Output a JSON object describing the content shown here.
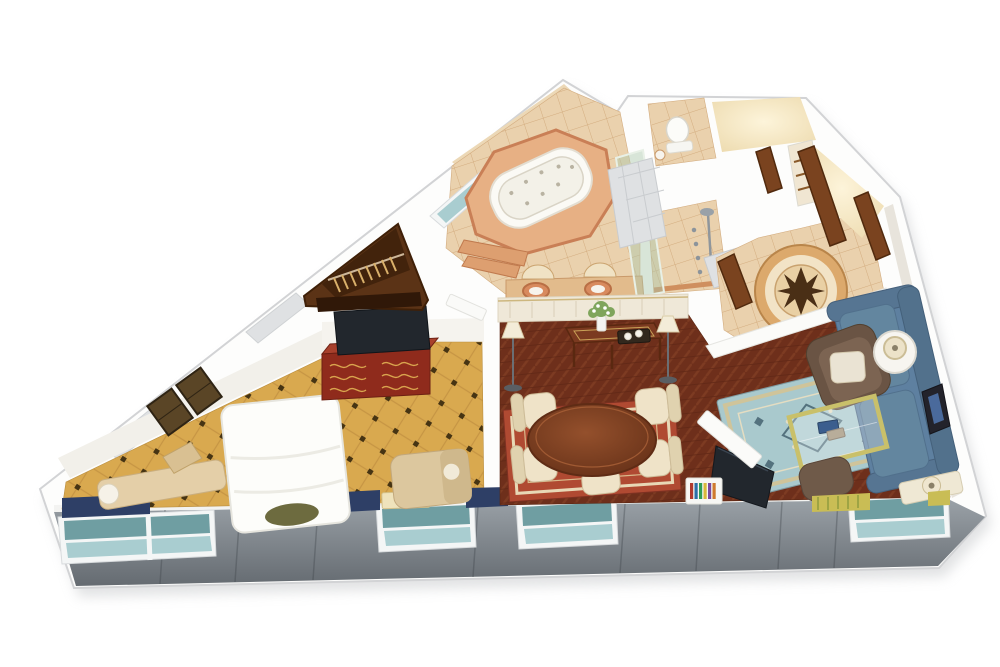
{
  "meta": {
    "subject": "isometric-3d-cutaway-floor-plan-of-hotel-suite",
    "background": "#ffffff",
    "width": 1000,
    "height": 667
  },
  "palette": {
    "wall_white": "#fdfdfc",
    "wall_shadow": "#c9cbcd",
    "wall_face": "#f2f0ea",
    "band_top": "#9aa1a7",
    "band_bottom": "#656b71",
    "window_frame": "#f4f6f6",
    "glass_dark": "#6f9ea2",
    "glass_light": "#a9cdd0",
    "carpet_gold": "#d9a94f",
    "carpet_line": "#c69544",
    "carpet_dot": "#463413",
    "wood_floor": "#6e2f1b",
    "wood_grain": "#7d3b22",
    "tile_tan": "#ead1ad",
    "tile_line": "#d3ac7f",
    "marble": "#dfe1e3",
    "closet_wood": "#5b3316",
    "closet_wood_dark": "#42230c",
    "hanger": "#d9b06a",
    "dresser_red": "#8f2b1c",
    "dresser_top": "#a8402c",
    "tv_dark": "#22272d",
    "bed_white": "#fdfdfa",
    "pillow_olive": "#6d6b3f",
    "bench_tan": "#e4cfa8",
    "lounge_tan": "#dcc79e",
    "valance_navy": "#2e3f66",
    "valance_yellow": "#c9bd55",
    "rug_red": "#b04a32",
    "rug_red_border": "#e8d8b6",
    "rug_blue": "#a9c9cd",
    "rug_blue_motif": "#54727e",
    "sofa_blue": "#5e80a0",
    "armchair_brown": "#6a5444",
    "chair_cream": "#efe3c8",
    "table_wood": "#7b3a20",
    "lamp_shade": "#f3ecd8",
    "door_wood": "#7a431f",
    "tub_white": "#fbfaf5",
    "platform_terracotta": "#e7b084",
    "platform_rim": "#c97f56",
    "shower_glass": "#aac8ae",
    "medallion_ring": "#dca96c",
    "medallion_star": "#4a2f16",
    "glow_warm": "#fdf4da",
    "paneled_wall": "#efe8d8",
    "vanity_counter": "#e2bb8c",
    "sink_terracotta": "#d88a5e"
  },
  "rooms": [
    {
      "id": "bedroom",
      "floor": "gold-diamond-pattern-carpet"
    },
    {
      "id": "walk-in-closet",
      "floor": "dark-wood"
    },
    {
      "id": "bathroom",
      "floor": "tan-tile"
    },
    {
      "id": "shower-room",
      "floor": "tan-tile"
    },
    {
      "id": "water-closet",
      "floor": "tan-tile"
    },
    {
      "id": "hallway",
      "floor": "marble-tile"
    },
    {
      "id": "entry-foyer",
      "floor": "tan-tile-with-compass-medallion"
    },
    {
      "id": "dining-area",
      "floor": "herringbone-wood"
    },
    {
      "id": "sitting-area",
      "floor": "herringbone-wood"
    }
  ],
  "furniture": {
    "bedroom": [
      "king-bed",
      "olive-accent-pillow",
      "window-bench",
      "lounge-chair",
      "writing-desk",
      "desk-lamp",
      "dresser",
      "flat-tv",
      "wall-art-frames",
      "navy-window-valances"
    ],
    "walk-in-closet": [
      "hanging-rod",
      "wood-hangers",
      "shelf"
    ],
    "bathroom": [
      "jacuzzi-tub",
      "tiled-tub-platform",
      "platform-steps",
      "double-sink-vanity",
      "arched-mirrors",
      "diagonal-window"
    ],
    "shower-room": [
      "walk-in-shower",
      "glass-partition",
      "body-jets",
      "shower-head"
    ],
    "water-closet": [
      "toilet",
      "small-sink"
    ],
    "entry-foyer": [
      "compass-rose-medallion",
      "tile-threshold",
      "wood-closet-doors",
      "shelf-niche"
    ],
    "dining-area": [
      "oval-dining-table",
      "four-upholstered-chairs",
      "table-stool",
      "red-oriental-rug",
      "console-table",
      "flower-vase",
      "coffee-tray",
      "two-floor-lamps",
      "paneled-wall"
    ],
    "sitting-area": [
      "blue-sofa",
      "wingback-armchair",
      "round-side-table",
      "table-lamp",
      "glass-coffee-table",
      "books",
      "television",
      "media-shelf-with-books",
      "ottoman",
      "blue-oriental-rug",
      "framed-wall-art",
      "console-desk",
      "desk-lamp",
      "yellow-window-valances"
    ]
  },
  "windows": {
    "band_windows": 4,
    "diagonal_window": 1,
    "glazing": "teal",
    "exterior_band": "gray-panels"
  },
  "doors": {
    "wood": 4,
    "white": 1
  }
}
